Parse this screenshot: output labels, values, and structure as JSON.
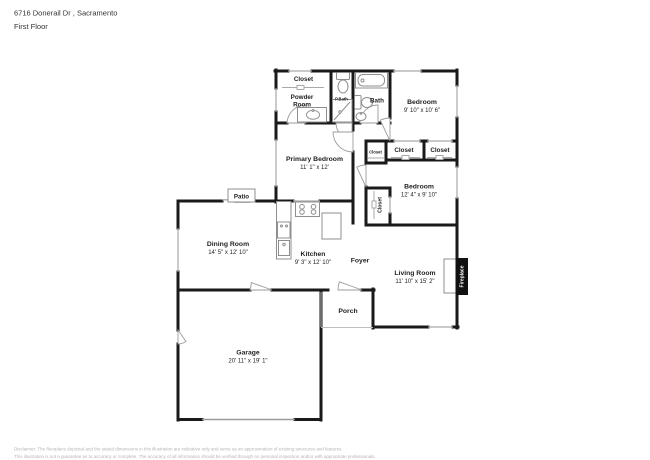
{
  "header": {
    "address": "6716 Donerail Dr , Sacramento",
    "floor": "First Floor"
  },
  "rooms": {
    "closet_top": {
      "name": "Closet"
    },
    "powder_room": {
      "line1": "Powder",
      "line2": "Room"
    },
    "primary_bath": {
      "name": "P.Bath"
    },
    "bath": {
      "name": "Bath"
    },
    "bedroom_top": {
      "name": "Bedroom",
      "dims": "9' 10\" x 10' 6\""
    },
    "primary_bedroom": {
      "name": "Primary Bedroom",
      "dims": "11' 1\" x 12'"
    },
    "closet_hall": {
      "name": "Closet"
    },
    "closet_left": {
      "name": "Closet"
    },
    "closet_right": {
      "name": "Closet"
    },
    "bedroom_mid": {
      "name": "Bedroom",
      "dims": "12' 4\" x 9' 10\""
    },
    "closet_bedroom": {
      "name": "Closet"
    },
    "patio": {
      "name": "Patio"
    },
    "dining_room": {
      "name": "Dining Room",
      "dims": "14' 5\" x 12' 10\""
    },
    "kitchen": {
      "name": "Kitchen",
      "dims": "9' 3\" x 12' 10\""
    },
    "foyer": {
      "name": "Foyer"
    },
    "living_room": {
      "name": "Living Room",
      "dims": "11' 10\" x 15' 2\""
    },
    "fireplace": {
      "name": "Fireplace"
    },
    "porch": {
      "name": "Porch"
    },
    "garage": {
      "name": "Garage",
      "dims": "20' 11\" x 19' 1\""
    }
  },
  "disclaimer": {
    "line1": "Disclaimer: The floorplans depicted and the stated dimensions in this illustration are indicative only and serve as an approximation of existing structures and features.",
    "line2": "This illustration is not a guarantee as to accuracy or complete. The accuracy of all information should be verified through an personal inspection and/or with appropriate professionals."
  },
  "icons": [
    "toilet-icon",
    "bathtub-icon",
    "shower-icon",
    "sink-icon",
    "vanity-sink-icon",
    "stove-icon",
    "refrigerator-icon",
    "kitchen-sink-icon",
    "fireplace-block"
  ],
  "colors": {
    "wall": "#1a1a1a",
    "fixture": "#9b9b9b",
    "text": "#1f1f1f",
    "muted_text": "#b5b5b5",
    "fireplace_bg": "#111111",
    "background": "#ffffff"
  }
}
